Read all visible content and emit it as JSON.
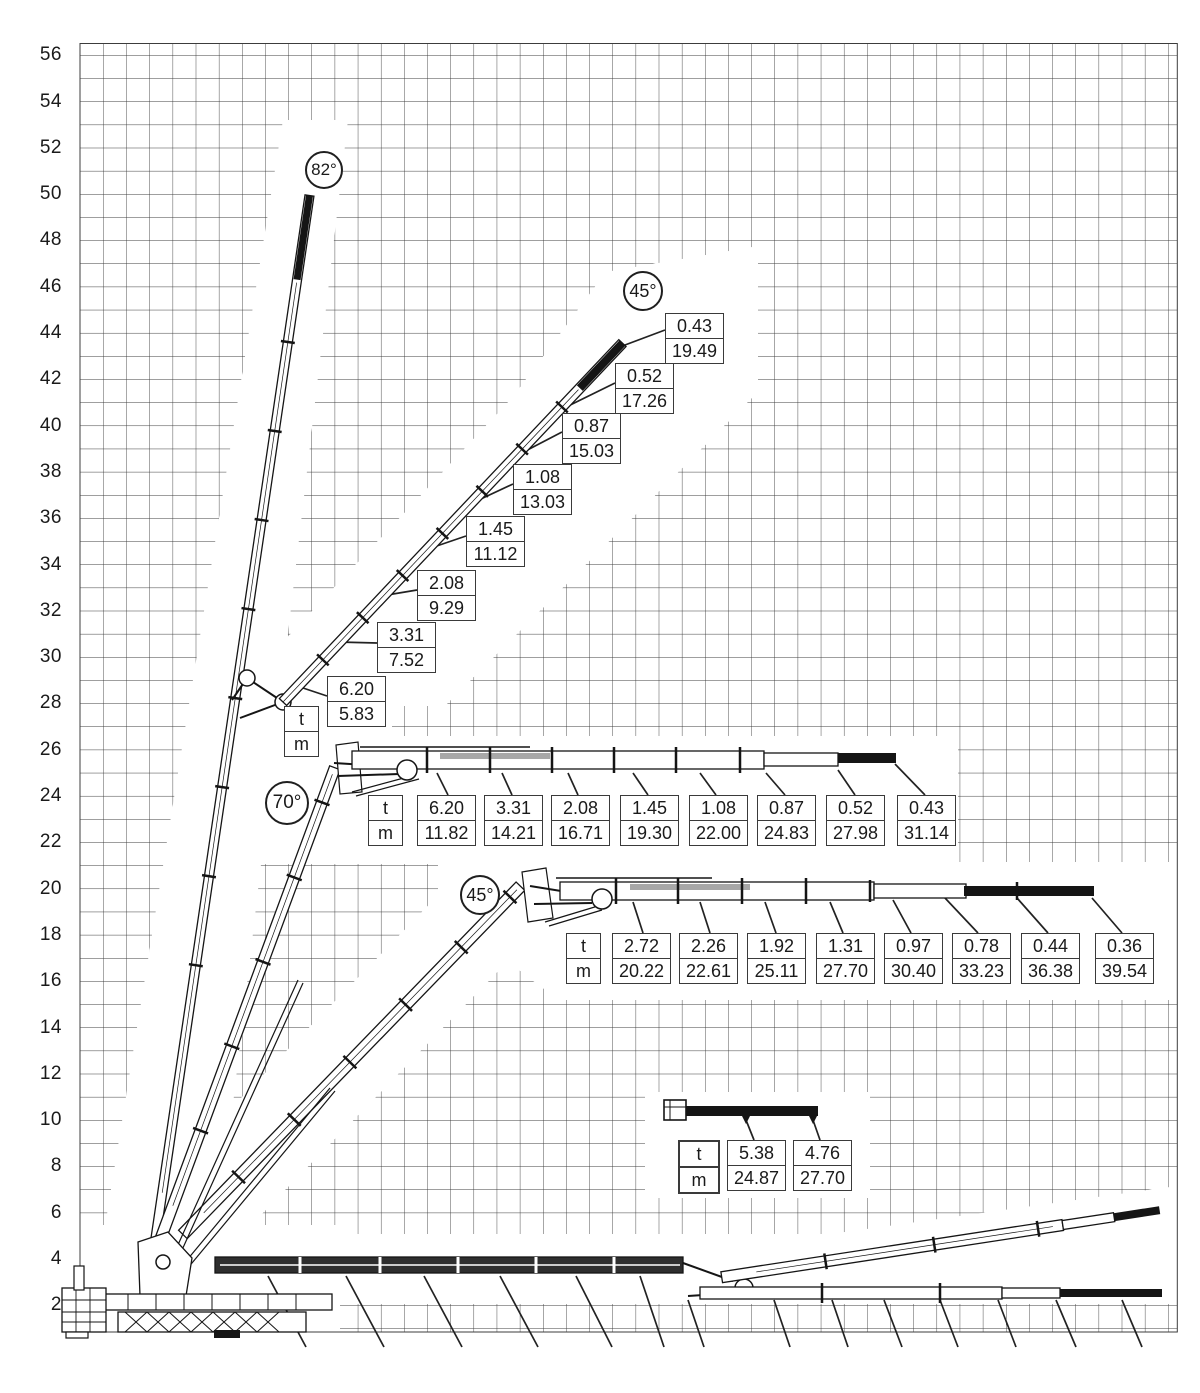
{
  "axis": {
    "labels": [
      "56",
      "54",
      "52",
      "50",
      "48",
      "46",
      "44",
      "42",
      "40",
      "38",
      "36",
      "34",
      "32",
      "30",
      "28",
      "26",
      "24",
      "22",
      "20",
      "18",
      "16",
      "14",
      "12",
      "10",
      "8",
      "6",
      "4",
      "2"
    ]
  },
  "angles": {
    "boom_82": "82°",
    "jib_45_upper": "45°",
    "boom_70": "70°",
    "jib_45_lower": "45°"
  },
  "legend": {
    "t": "t",
    "m": "m"
  },
  "tables": {
    "diagonal_45": [
      {
        "t": "0.43",
        "m": "19.49"
      },
      {
        "t": "0.52",
        "m": "17.26"
      },
      {
        "t": "0.87",
        "m": "15.03"
      },
      {
        "t": "1.08",
        "m": "13.03"
      },
      {
        "t": "1.45",
        "m": "11.12"
      },
      {
        "t": "2.08",
        "m": "9.29"
      },
      {
        "t": "3.31",
        "m": "7.52"
      },
      {
        "t": "6.20",
        "m": "5.83"
      }
    ],
    "horizontal_70": [
      {
        "t": "6.20",
        "m": "11.82"
      },
      {
        "t": "3.31",
        "m": "14.21"
      },
      {
        "t": "2.08",
        "m": "16.71"
      },
      {
        "t": "1.45",
        "m": "19.30"
      },
      {
        "t": "1.08",
        "m": "22.00"
      },
      {
        "t": "0.87",
        "m": "24.83"
      },
      {
        "t": "0.52",
        "m": "27.98"
      },
      {
        "t": "0.43",
        "m": "31.14"
      }
    ],
    "horizontal_45": [
      {
        "t": "2.72",
        "m": "20.22"
      },
      {
        "t": "2.26",
        "m": "22.61"
      },
      {
        "t": "1.92",
        "m": "25.11"
      },
      {
        "t": "1.31",
        "m": "27.70"
      },
      {
        "t": "0.97",
        "m": "30.40"
      },
      {
        "t": "0.78",
        "m": "33.23"
      },
      {
        "t": "0.44",
        "m": "36.38"
      },
      {
        "t": "0.36",
        "m": "39.54"
      }
    ],
    "jib_extension": [
      {
        "t": "5.38",
        "m": "24.87"
      },
      {
        "t": "4.76",
        "m": "27.70"
      }
    ]
  }
}
